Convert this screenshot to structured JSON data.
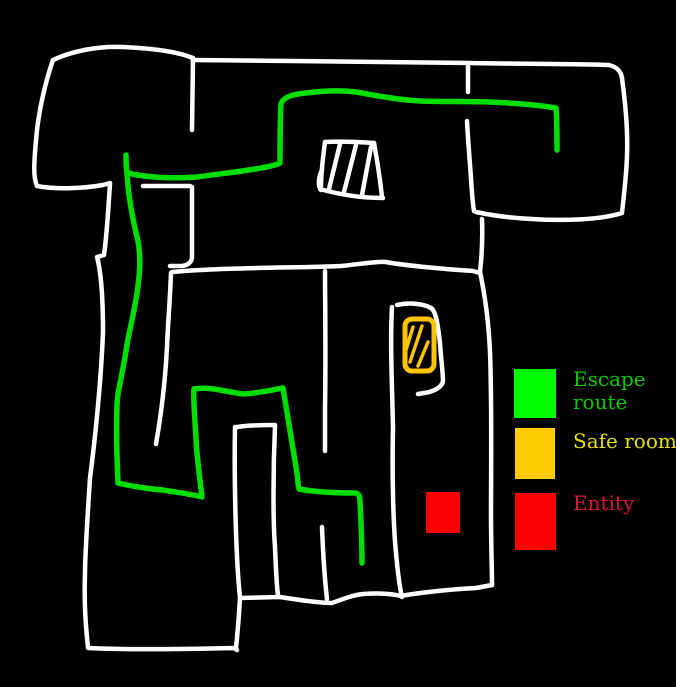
{
  "colors": {
    "background": "#000000",
    "wall": "#ffffff",
    "escape_route": "#00dd00",
    "safe_room": "#ffc400",
    "entity": "#ff0000"
  },
  "map_markers": [
    {
      "name": "escape-route-line",
      "type": "freehand-path",
      "color": "#00dd00"
    },
    {
      "name": "hatched-zone",
      "type": "hatched-box",
      "color": "#ffffff"
    },
    {
      "name": "safe-room-box",
      "type": "hatched-box",
      "color": "#ffc400"
    },
    {
      "name": "entity-box",
      "type": "solid-square",
      "color": "#ff0000"
    }
  ],
  "legend": {
    "items": [
      {
        "label": "Escape route",
        "swatch_color": "#00ff00",
        "label_color": "#00cc00"
      },
      {
        "label": "Safe room",
        "swatch_color": "#ffcc00",
        "label_color": "#e9e300"
      },
      {
        "label": "Entity",
        "swatch_color": "#ff0000",
        "label_color": "#d81535"
      }
    ]
  }
}
